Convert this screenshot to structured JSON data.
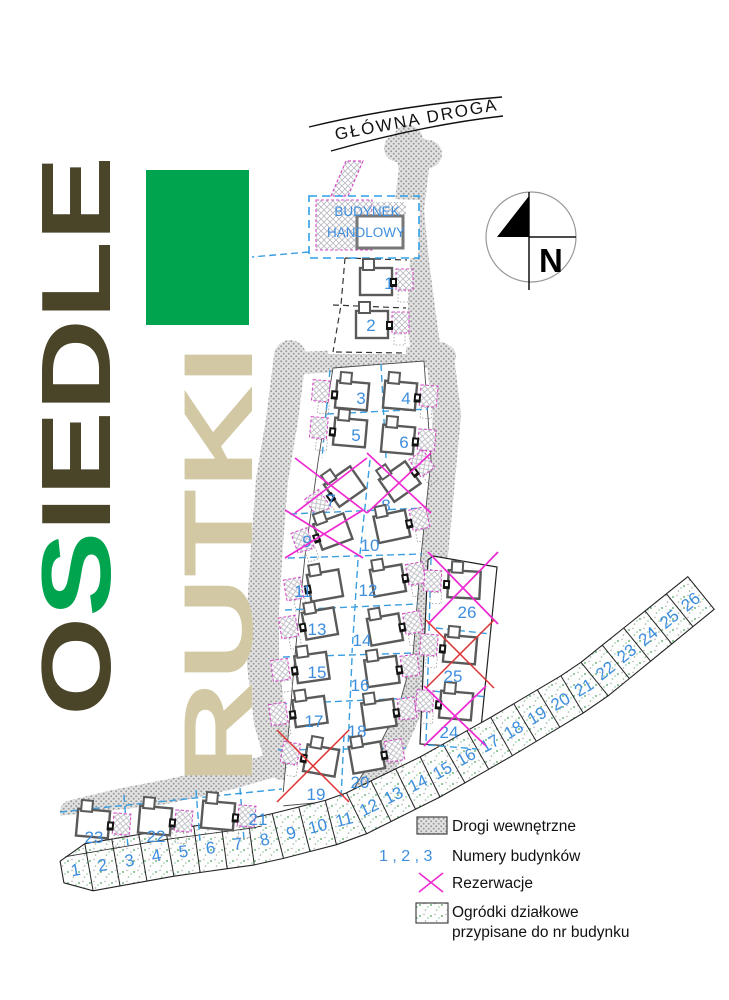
{
  "branding": {
    "word1": "OSIEDLE",
    "word1_accent_index": 1,
    "word2": "RUTKI"
  },
  "map_labels": {
    "main_road": "GŁÓWNA DROGA",
    "commercial_building_line1": "BUDYNEK",
    "commercial_building_line2": "HANDLOWY",
    "compass_north": "N"
  },
  "buildings": {
    "numbers": [
      1,
      2,
      3,
      4,
      5,
      6,
      7,
      8,
      9,
      10,
      11,
      12,
      13,
      14,
      15,
      16,
      17,
      18,
      19,
      20,
      21,
      22,
      23,
      24,
      25,
      26
    ]
  },
  "garden_plots": {
    "numbers": [
      1,
      2,
      3,
      4,
      5,
      6,
      7,
      8,
      9,
      10,
      11,
      12,
      13,
      14,
      15,
      16,
      17,
      18,
      19,
      20,
      21,
      22,
      23,
      24,
      25,
      26
    ]
  },
  "reservations": {
    "magenta_buildings": [
      7,
      8,
      9,
      24,
      26
    ],
    "red_buildings": [
      19,
      25
    ]
  },
  "legend": {
    "items": [
      {
        "id": "roads",
        "label": "Drogi wewnętrzne"
      },
      {
        "id": "building_numbers",
        "swatch_text": "1 , 2 , 3",
        "label": "Numery budynków"
      },
      {
        "id": "reservations",
        "label": "Rezerwacje"
      },
      {
        "id": "gardens",
        "label_line1": "Ogródki działkowe",
        "label_line2": "przypisane do nr budynku"
      }
    ]
  },
  "colors": {
    "accent_green": "#00a44f",
    "title_olive": "#4a4429",
    "title_tan": "#d2c9a4",
    "number_blue": "#3e8ede",
    "parcel_blue": "#3a9fe0",
    "reservation_magenta": "#ee2ad0",
    "reservation_red": "#e03232",
    "road_gray": "#9b9b9b"
  }
}
